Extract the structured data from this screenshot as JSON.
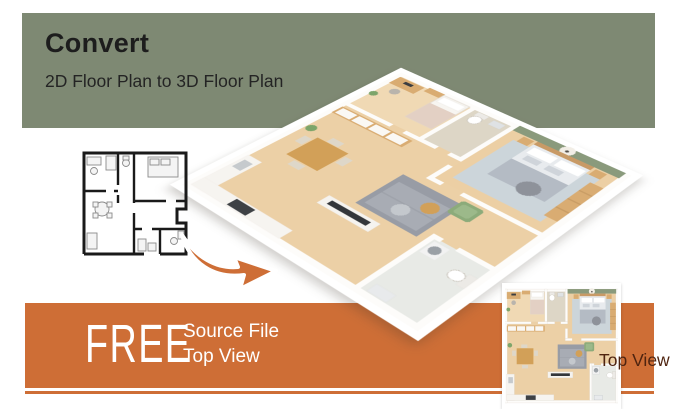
{
  "header": {
    "title": "Convert",
    "subtitle": "2D Floor Plan to 3D Floor Plan"
  },
  "banner": {
    "free_label": "FREE",
    "offer_line1": "Source File",
    "offer_line2": "Top View"
  },
  "topview": {
    "caption": "Top View"
  },
  "images": {
    "floorplan_2d": "2d-floor-plan-line-drawing",
    "floorplan_3d": "3d-isometric-floor-plan-render",
    "floorplan_topview": "3d-top-view-floor-plan-render",
    "arrow": "orange-curved-arrow"
  },
  "colors": {
    "green": "#7e8973",
    "orange": "#ce6e36",
    "title-text": "#1d1d1d",
    "banner-text": "#ffffff",
    "topview-text": "#4f2410"
  }
}
